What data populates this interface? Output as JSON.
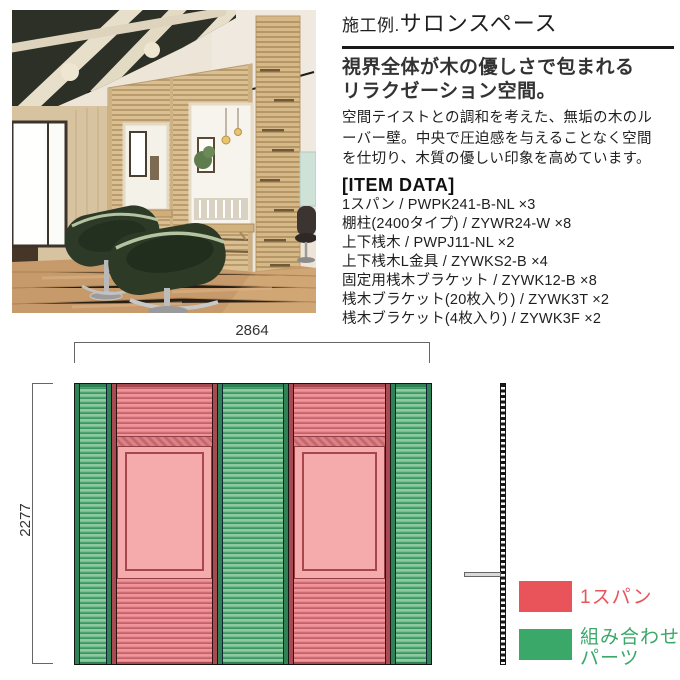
{
  "header": {
    "title_prefix": "施工例.",
    "title_main": "サロンスペース",
    "subtitle_line1": "視界全体が木の優しさで包まれる",
    "subtitle_line2": "リラクゼーション空間。",
    "body_lines": [
      "空間テイストとの調和を考えた、無垢の木のル",
      "ーバー壁。中央で圧迫感を与えることなく空間",
      "を仕切り、木質の優しい印象を高めています。"
    ]
  },
  "item_data": {
    "heading": "[ITEM DATA]",
    "items": [
      "1スパン / PWPK241-B-NL ×3",
      "棚柱(2400タイプ) / ZYWR24-W ×8",
      "上下桟木 / PWPJ11-NL ×2",
      "上下桟木L金具 / ZYWKS2-B ×4",
      "固定用桟木ブラケット / ZYWK12-B ×8",
      "桟木ブラケット(20枚入り) / ZYWK3T ×2",
      "桟木ブラケット(4枚入り) / ZYWK3F ×2"
    ]
  },
  "diagram": {
    "width_label": "2864",
    "height_label": "2277",
    "panel_pattern": [
      "green",
      "red",
      "green",
      "red",
      "green"
    ],
    "colors": {
      "span_red": "#e9545a",
      "combination_green": "#3aa869",
      "panel_red_light": "#f0969a",
      "panel_red_dark": "#c4606a",
      "panel_green_light": "#8fc99e",
      "panel_green_dark": "#3c9565",
      "mirror_pink": "#f5aaab"
    },
    "legend": [
      {
        "label": "1スパン",
        "color": "#e9545a"
      },
      {
        "label_line1": "組み合わせ",
        "label_line2": "パーツ",
        "color": "#3aa869"
      }
    ]
  }
}
